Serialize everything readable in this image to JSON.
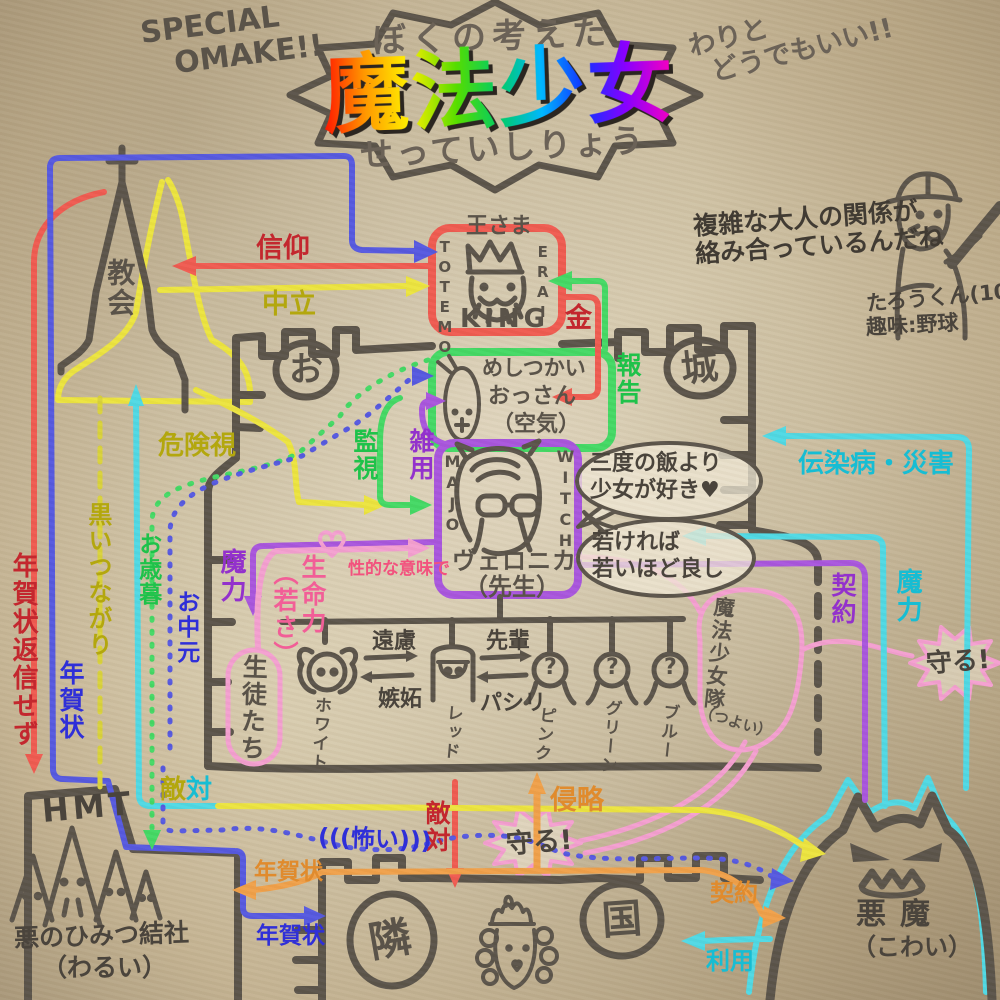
{
  "palette": {
    "ink": "#5a5349",
    "red_line": "#ef5a50",
    "red_label": "#c3272e",
    "blue": "#5558e0",
    "blue_label": "#2f2fd8",
    "yellow": "#ece43e",
    "olive_label": "#b3a70e",
    "green": "#43d964",
    "green_label": "#1fc24a",
    "cyan": "#4fd9e4",
    "cyan_label": "#17bdd3",
    "purple": "#a855dd",
    "purple_label": "#9331cc",
    "pink": "#f49fd0",
    "pink_label": "#f272aa",
    "orange": "#f0a049",
    "orange_label": "#e08b2d"
  },
  "header": {
    "omake1": "SPECIAL",
    "omake2": "OMAKE!!",
    "pre": "ぼくの考えた",
    "title": "魔法少女",
    "sub": "せっていしりょう",
    "aside1": "わりと",
    "aside2": "どうでもいい!!"
  },
  "comment": {
    "l1": "複雑な大人の関係が",
    "l2": "絡み合っているんだね",
    "author": "たろうくん(10)",
    "hobby": "趣味:野球"
  },
  "king": {
    "top": "王さま",
    "left": "TOTEMO",
    "right": "ERAI",
    "bottom": "KING"
  },
  "servant": {
    "l1": "めしつかい",
    "l2": "おっさん",
    "l3": "（空気）"
  },
  "witch": {
    "left": "MAJO",
    "right": "WITCH",
    "name": "ヴェロニカ",
    "title": "（先生）"
  },
  "church": {
    "name": "教会"
  },
  "castle": {
    "o": "お",
    "shiro": "城"
  },
  "students": {
    "group": "生徒たち",
    "names": [
      "ホワイト",
      "レッド",
      "ピンク",
      "グリーン",
      "ブルー"
    ],
    "marks": [
      "?",
      "?",
      "?"
    ]
  },
  "squad": {
    "name": "魔法少女隊",
    "note": "（つよい）"
  },
  "hmt": {
    "name": "HMT",
    "sub1": "悪のひみつ結社",
    "sub2": "（わるい）"
  },
  "neighbor": {
    "c1": "隣",
    "c2": "国"
  },
  "demon": {
    "name": "悪魔",
    "note": "（こわい）"
  },
  "bubbles": {
    "b1l1": "三度の飯より",
    "b1l2": "少女が好き♥",
    "b2l1": "若ければ",
    "b2l2": "若いほど良し"
  },
  "labels": {
    "faith": "信仰",
    "neutral": "中立",
    "money": "金",
    "report": "報告",
    "surveil": "監視",
    "chores": "雑用",
    "danger": "危険視",
    "darktie": "黒いつながり",
    "oseibo": "お歳暮",
    "ochugen": "お中元",
    "noreply": "年賀状返信せず",
    "nengajo_left": "年賀状",
    "mana_purple": "魔力",
    "life1": "生命力",
    "life2": "（若さ）",
    "sexual": "性的な意味で",
    "enryo": "遠慮",
    "shitto": "嫉妬",
    "senpai": "先輩",
    "pashiri": "パシリ",
    "plague": "伝染病・災害",
    "contract_purple": "契約",
    "mana_cyan": "魔力",
    "protect_right": "守る!",
    "protect_bottom": "守る!",
    "hostility1a": "敵",
    "hostility1b": "対",
    "hostility_red": "敵対",
    "scary": "(((怖い)))",
    "invade": "侵略",
    "nengajo_orange": "年賀状",
    "nengajo_blue": "年賀状",
    "contract_orange": "契約",
    "use": "利用"
  }
}
